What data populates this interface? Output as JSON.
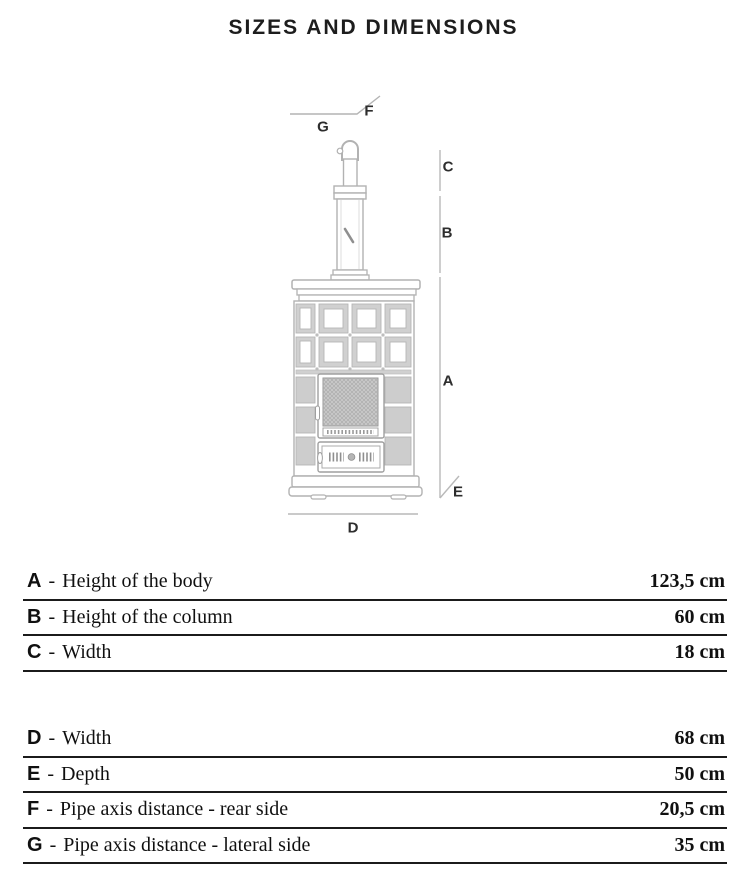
{
  "title": "SIZES AND DIMENSIONS",
  "diagram": {
    "description": "technical line drawing of ceramic wood stove with flue pipe and dimension callouts",
    "dimension_labels": {
      "a": "A",
      "b": "B",
      "c": "C",
      "d": "D",
      "e": "E",
      "f": "F",
      "g": "G"
    }
  },
  "spec_tables": {
    "separator": "-",
    "table1": {
      "rows": [
        {
          "key": "A",
          "desc": "Height of the body",
          "value": "123,5 cm"
        },
        {
          "key": "B",
          "desc": "Height of the column",
          "value": "60 cm"
        },
        {
          "key": "C",
          "desc": "Width",
          "value": "18 cm"
        }
      ]
    },
    "table2": {
      "rows": [
        {
          "key": "D",
          "desc": "Width",
          "value": "68 cm"
        },
        {
          "key": "E",
          "desc": "Depth",
          "value": "50 cm"
        },
        {
          "key": "F",
          "desc": "Pipe axis distance - rear side",
          "value": "20,5 cm"
        },
        {
          "key": "G",
          "desc": "Pipe axis distance - lateral side",
          "value": "35 cm"
        }
      ]
    }
  },
  "colors": {
    "drawing_line": "#b2b2b2",
    "drawing_fill": "#d0d0d0",
    "text": "#101010",
    "rule": "#1b1b1b"
  }
}
